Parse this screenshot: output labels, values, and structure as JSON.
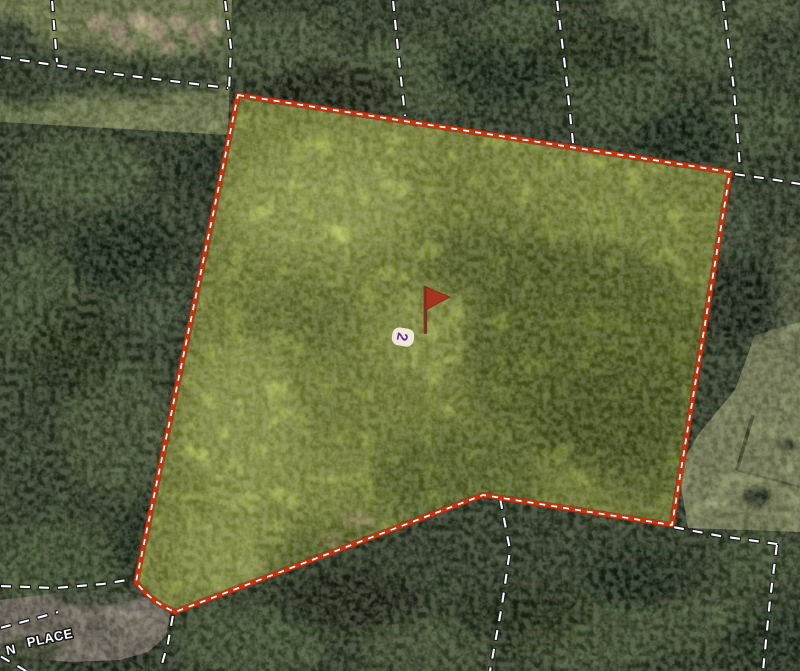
{
  "map": {
    "kind": "aerial-parcel-view",
    "background_forest_color": "#2e3d26",
    "paddock_color": "#7a8752",
    "road_color": "#7e766a"
  },
  "parcel": {
    "lot_number": "2",
    "lot_number_color": "#6a2d90",
    "lot_badge_color": "#f6f1e2",
    "overlay_fill": "#8e9c3c",
    "boundary_color": "#c23511",
    "boundary_dash_color": "#ffffff",
    "marker": {
      "icon": "flag-icon",
      "flag_color": "#a33420",
      "pole_color": "#7c3222"
    }
  },
  "street_label": {
    "prefix": "N",
    "name": "PLACE",
    "text_color": "#ffffff",
    "outline_color": "#161616"
  },
  "cadastral": {
    "dash_color": "#fdfdfd",
    "casing_color": "#1a1a1a"
  }
}
